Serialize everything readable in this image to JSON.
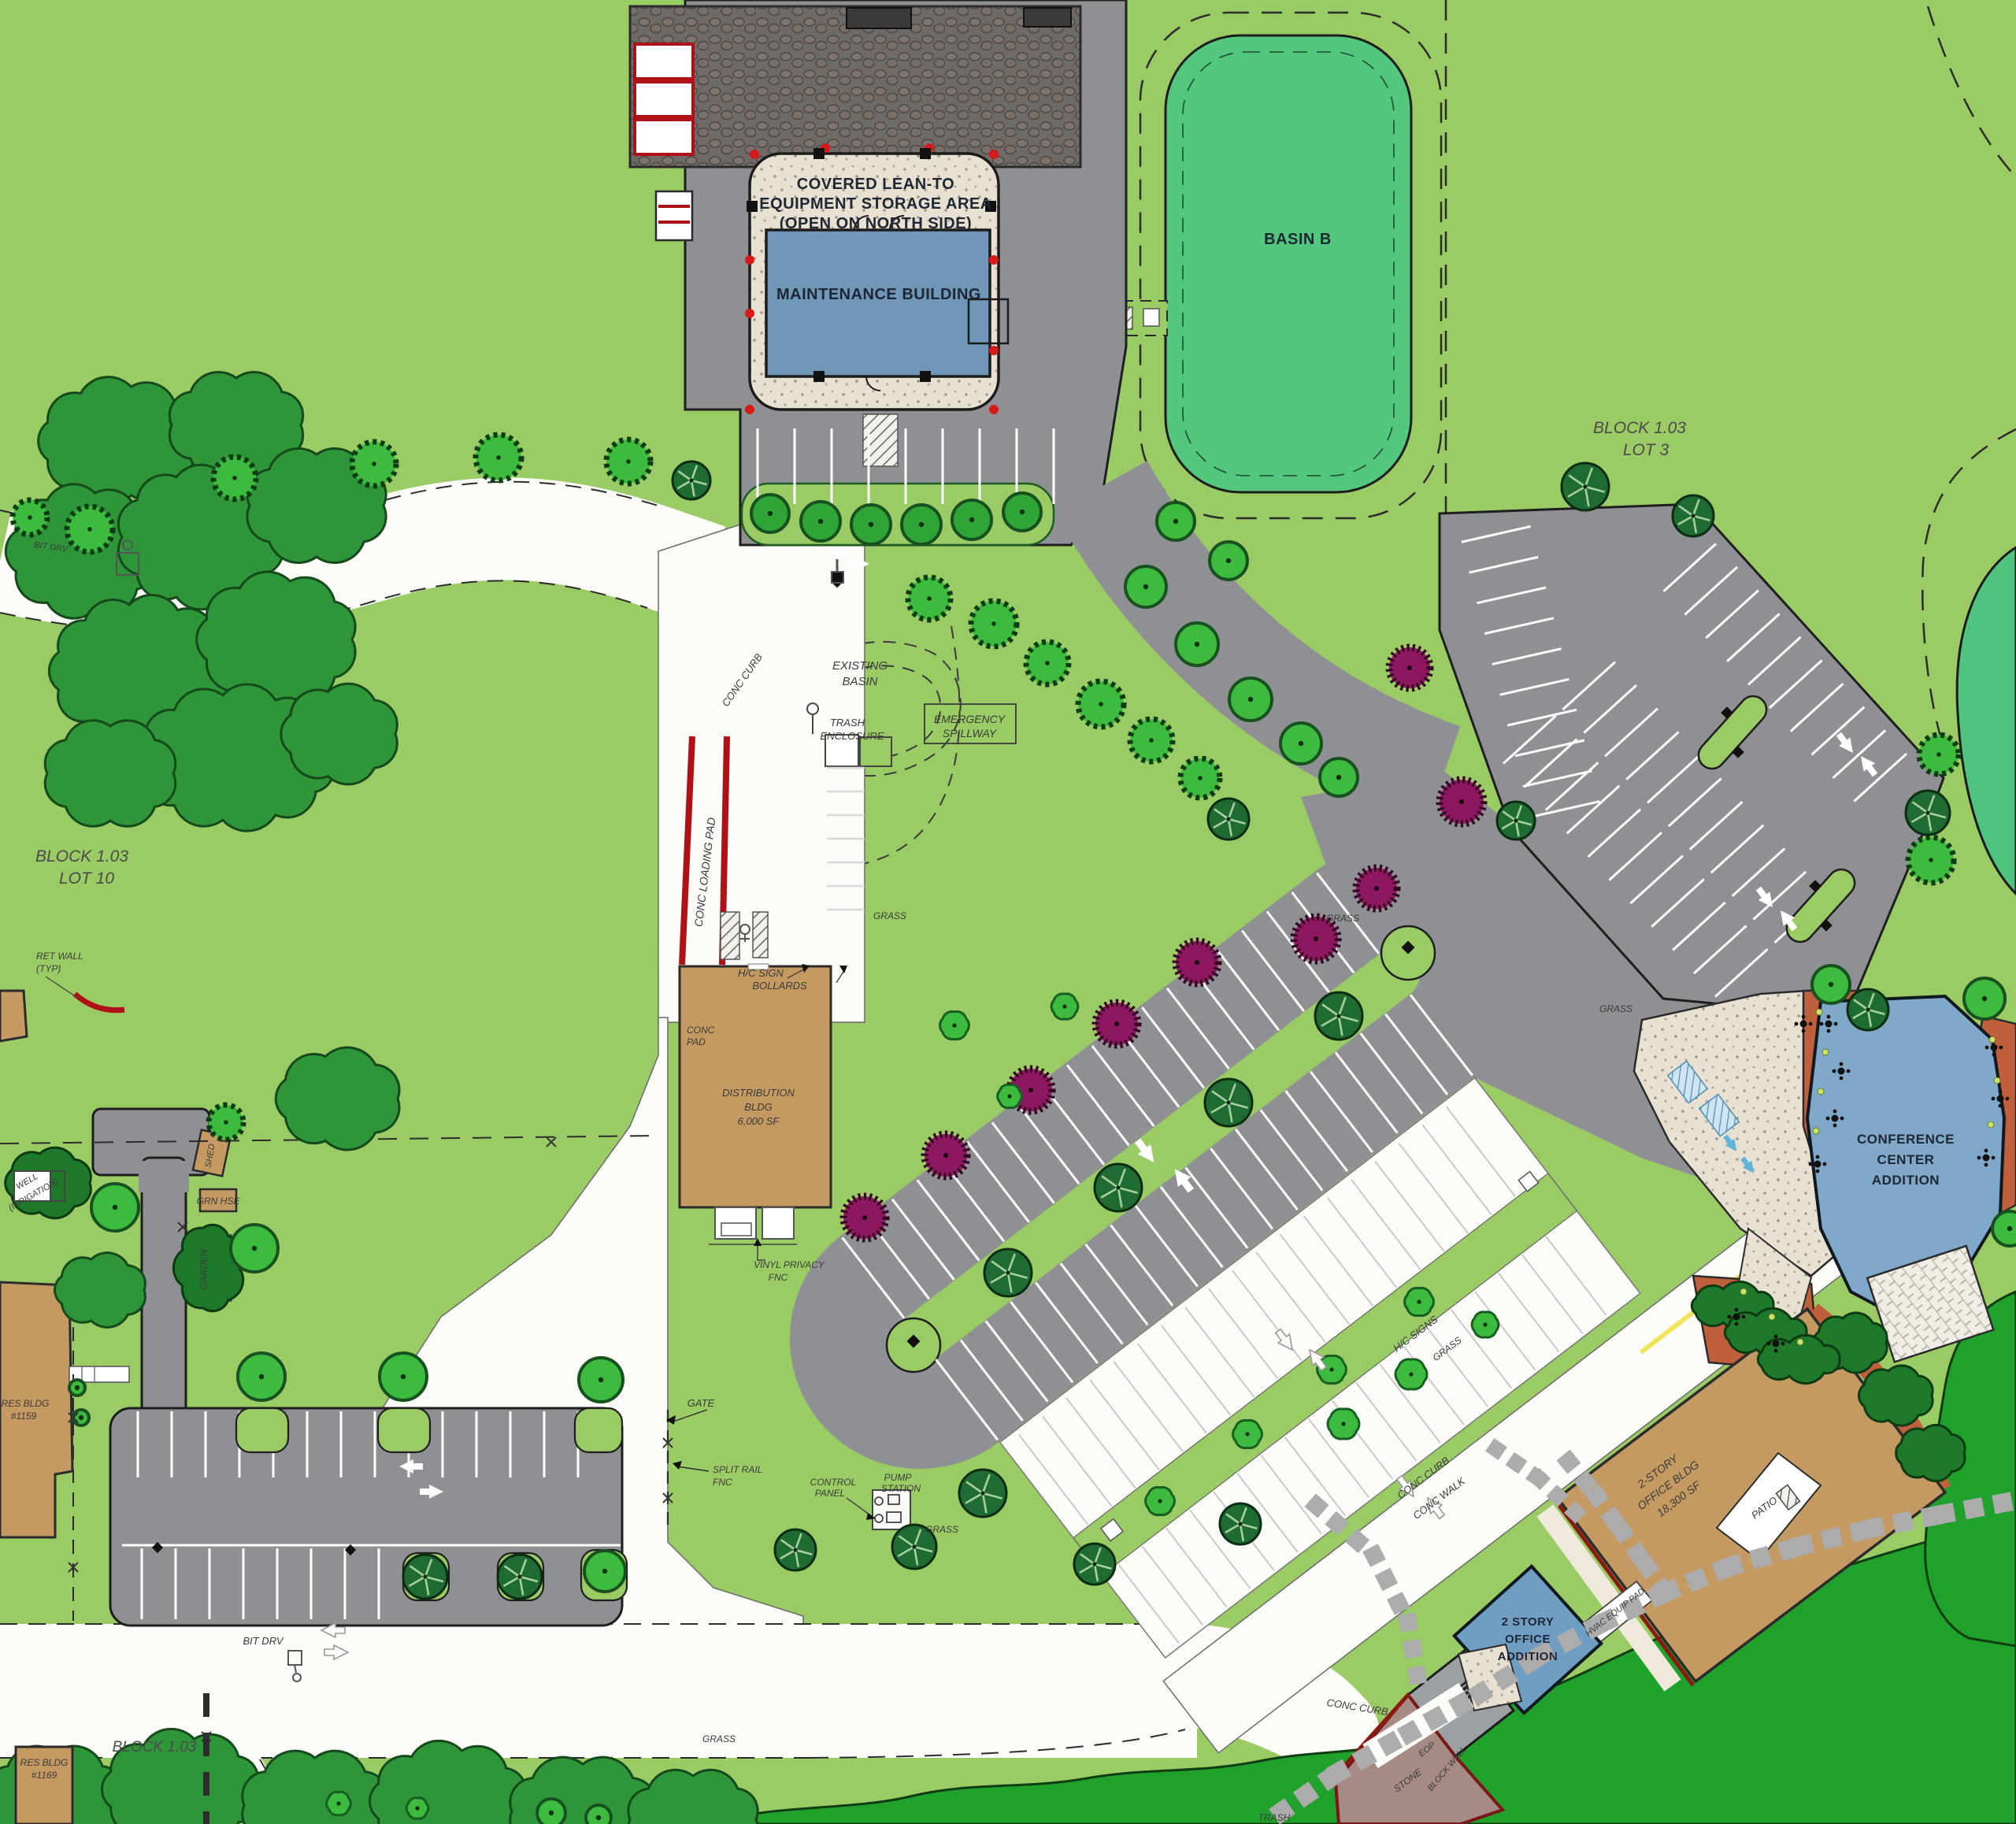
{
  "plan": {
    "labels": {
      "covered_1": "COVERED LEAN-TO",
      "covered_2": "EQUIPMENT STORAGE AREA",
      "covered_3": "(OPEN ON NORTH SIDE)",
      "maintenance_building": "MAINTENANCE BUILDING",
      "basin_b": "BASIN B",
      "block_103": "BLOCK 1.03",
      "lot_3": "LOT 3",
      "lot_10": "LOT 10",
      "existing_1": "EXISTING",
      "existing_2": "BASIN",
      "emergency_1": "EMERGENCY",
      "emergency_2": "SPILLWAY",
      "trash_enc_1": "TRASH",
      "trash_enc_2": "ENCLOSURE",
      "conc_curb": "CONC CURB",
      "conc_walk": "CONC WALK",
      "conc_loading_pad": "CONC LOADING PAD",
      "conc_pad_1": "CONC",
      "conc_pad_2": "PAD",
      "hc_sign_1": "H/C SIGN",
      "hc_sign_2": "BOLLARDS",
      "hc_signs": "H/C SIGNS",
      "distribution_1": "DISTRIBUTION",
      "distribution_2": "BLDG",
      "distribution_3": "6,000 SF",
      "vinyl_1": "VINYL PRIVACY",
      "vinyl_2": "FNC",
      "ret_wall_1": "RET WALL",
      "ret_wall_2": "(TYP)",
      "well_1": "WELL",
      "well_2": "(IRRIGATION)",
      "shed": "SHED",
      "grn_hse": "GRN HSE",
      "garden": "GARDEN",
      "gate": "GATE",
      "split_rail_1": "SPLIT RAIL",
      "split_rail_2": "FNC",
      "pump_1": "PUMP",
      "pump_2": "STATION",
      "control_1": "CONTROL",
      "control_2": "PANEL",
      "grass": "GRASS",
      "bit_drv": "BIT DRV",
      "conference_1": "CONFERENCE",
      "conference_2": "CENTER",
      "conference_3": "ADDITION",
      "office_1": "2-STORY",
      "office_2": "OFFICE BLDG",
      "office_3": "18,300 SF",
      "patio": "PATIO",
      "hvac": "HVAC EQUIP PAD",
      "addition_1": "2 STORY",
      "addition_2": "OFFICE",
      "addition_3": "ADDITION",
      "res_bldg": "RES BLDG",
      "res_1159": "#1159",
      "res_1169": "#1169",
      "eop": "EOP",
      "stone": "STONE",
      "block_wall": "BLOCK WALL",
      "trash": "TRASH"
    },
    "colors": {
      "ground": "#9BCB65",
      "canopy": "#2E9639",
      "canopy_bright": "#1FA12B",
      "tree": "#3CBB3F",
      "tree_ring": "#17511F",
      "tree_dark": "#1E6B33",
      "tree_purple": "#8E1860",
      "basin": "#53C77D",
      "pond": "#4EC47E",
      "water": "#6FA3C9",
      "asphalt": "#8E9093",
      "road": "#FBFBF8",
      "roof": "#6E6A67",
      "stone_apron": "#E8E0D0",
      "tan": "#C49A62",
      "blue": "#7096B8",
      "conference_blue": "#7FA8C9",
      "terracotta": "#C05F3C",
      "red": "#B01116",
      "yellow": "#EFE45A",
      "paver": "#ACACAC"
    }
  }
}
